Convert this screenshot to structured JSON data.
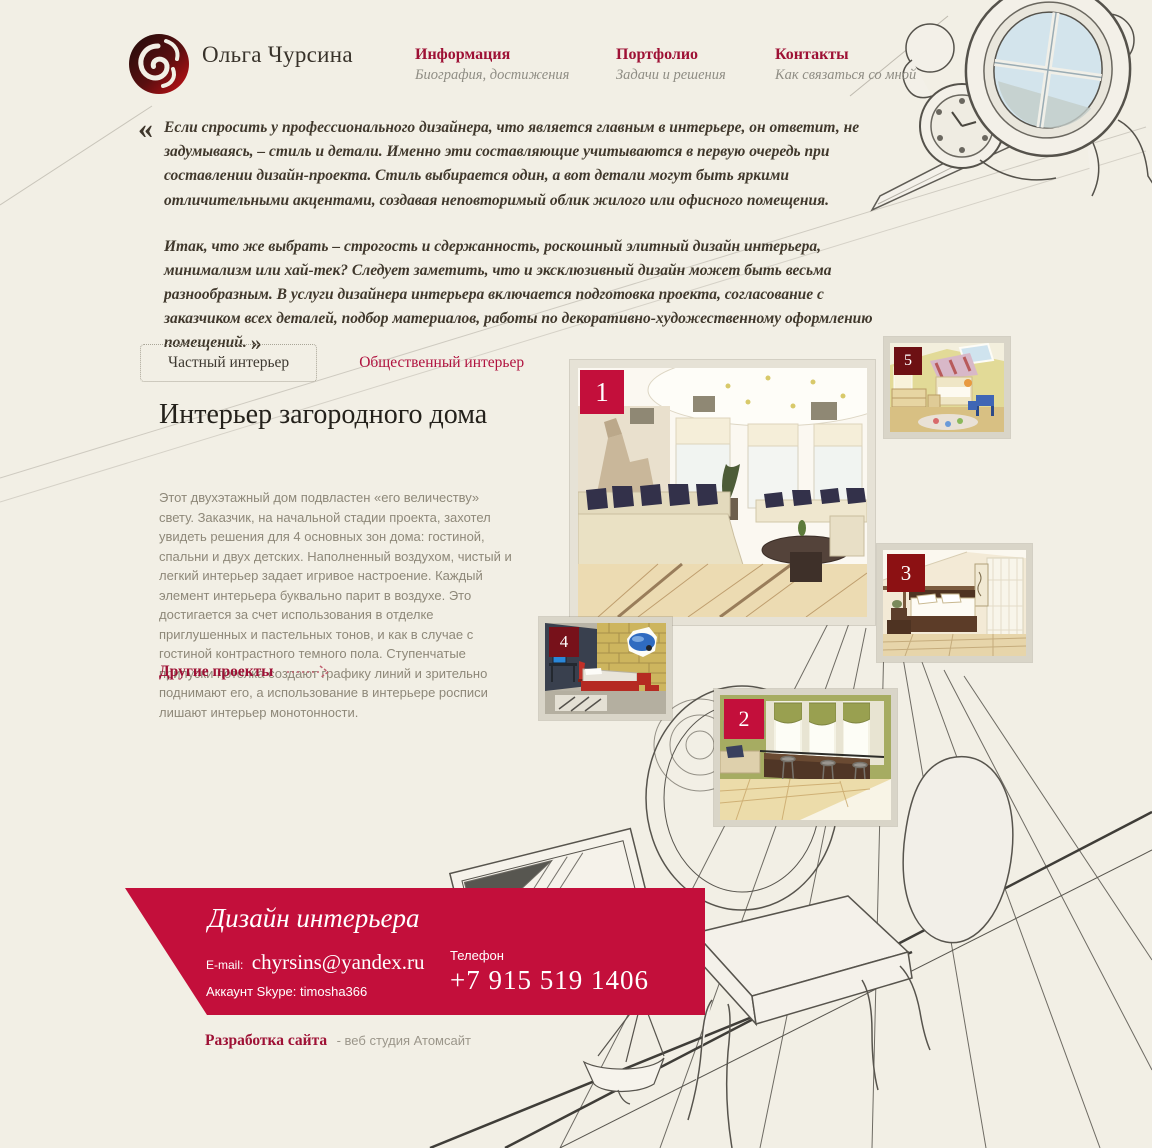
{
  "header": {
    "logo_title": "Ольга Чурсина",
    "nav": [
      {
        "label": "Информация",
        "sublabel": "Биография, достижения"
      },
      {
        "label": "Портфолио",
        "sublabel": "Задачи и решения"
      },
      {
        "label": "Контакты",
        "sublabel": "Как связаться со мной"
      }
    ]
  },
  "intro": {
    "quote_open": "«",
    "quote_close": "»",
    "p1": "Если спросить у профессионального дизайнера, что является главным в интерьере, он ответит, не задумываясь, – стиль и детали. Именно эти составляющие учитываются в первую очередь при составлении дизайн-проекта. Стиль выбирается один, а вот детали могут быть яркими отличительными акцентами, создавая неповторимый облик жилого или офисного помещения.",
    "p2": "Итак, что же выбрать – строгость и сдержанность, роскошный элитный дизайн интерьера, минимализм или хай-тек? Следует заметить, что и эксклюзивный дизайн может быть весьма разнообразным. В услуги дизайнера интерьера включается подготовка проекта, согласование с заказчиком всех деталей, подбор материалов, работы по декоративно-художественному оформлению помещений."
  },
  "tabs": [
    {
      "label": "Частный интерьер",
      "active": true
    },
    {
      "label": "Общественный интерьер",
      "active": false
    }
  ],
  "project": {
    "title": "Интерьер загородного дома",
    "description": "Этот двухэтажный дом подвластен «его величеству» свету. Заказчик, на начальной стадии проекта, захотел увидеть решения для 4 основных зон дома: гостиной, спальни и двух детских. Наполненный воздухом, чистый и легкий интерьер задает игривое настроение. Каждый элемент интерьера буквально парит в воздухе. Это достигается за счет использования в отделке приглушенных и пастельных тонов, и как в случае с гостиной контрастного темного пола. Ступенчатые припуски потолка создают графику линий и зрительно поднимают его, а использование в интерьере росписи лишают интерьер монотонности.",
    "more_link": "Другие проекты"
  },
  "gallery": {
    "items": [
      {
        "number": "1",
        "alt": "гостиная с диванами и круглым столом"
      },
      {
        "number": "2",
        "alt": "кухня-гостиная с барной стойкой"
      },
      {
        "number": "3",
        "alt": "спальня в восточном стиле"
      },
      {
        "number": "4",
        "alt": "детская с кирпичной стеной и машиной"
      },
      {
        "number": "5",
        "alt": "детская мансардная комната"
      }
    ]
  },
  "footer": {
    "banner_title": "Дизайн интерьера",
    "email_label": "E-mail:",
    "email": "chyrsins@yandex.ru",
    "skype_label": "Аккаунт Skype:",
    "skype": "timosha366",
    "phone_label": "Телефон",
    "phone": "+7 915 519 1406"
  },
  "credits": {
    "link": "Разработка сайта",
    "text": "- веб студия Атомсайт"
  },
  "colors": {
    "background": "#f2efe5",
    "accent": "#c30f3b",
    "badge_dark": "#7c1014",
    "nav_link": "#9e1135",
    "body_text": "#8e8879"
  }
}
